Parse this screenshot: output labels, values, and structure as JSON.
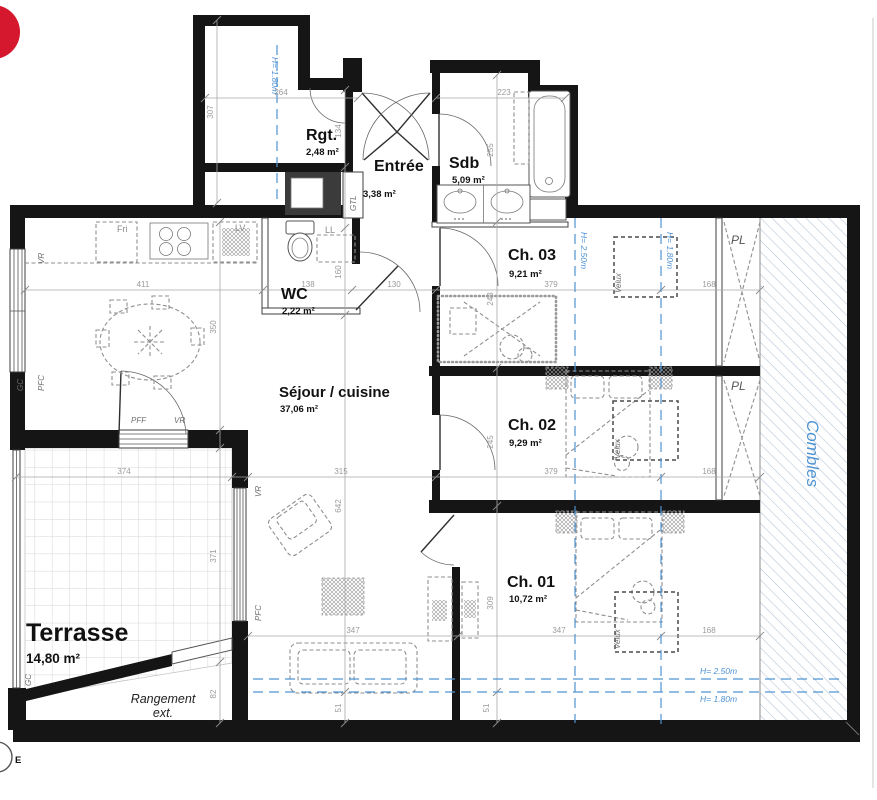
{
  "rooms": {
    "rgt": {
      "name": "Rgt.",
      "area": "2,48 m²"
    },
    "entree": {
      "name": "Entrée",
      "area": "3,38 m²"
    },
    "sdb": {
      "name": "Sdb",
      "area": "5,09 m²"
    },
    "wc": {
      "name": "WC",
      "area": "2,22 m²"
    },
    "ch03": {
      "name": "Ch. 03",
      "area": "9,21 m²"
    },
    "ch02": {
      "name": "Ch. 02",
      "area": "9,29 m²"
    },
    "ch01": {
      "name": "Ch. 01",
      "area": "10,72 m²"
    },
    "sejour": {
      "name": "Séjour / cuisine",
      "area": "37,06 m²"
    },
    "terrasse": {
      "name": "Terrasse",
      "area": "14,80 m²"
    }
  },
  "annotations": {
    "pl": "PL",
    "velux": "Velux",
    "combles": "Combles",
    "gtl": "GTL",
    "ll": "LL",
    "lv": "LV",
    "fri": "Fri",
    "vr": "VR",
    "pfc": "PFC",
    "pff": "PFF",
    "gc": "GC",
    "rangement_1": "Rangement",
    "rangement_2": "ext.",
    "compass_e": "E"
  },
  "height_markers": {
    "h250": "H= 2.50m",
    "h180": "H= 1.80m"
  },
  "dimensions": {
    "v307": "307",
    "h264": "264",
    "v134": "134",
    "h223": "223",
    "v255": "255",
    "h411": "411",
    "h138": "138",
    "h130": "130",
    "v160": "160",
    "v350": "350",
    "v243": "243",
    "h379_ch03": "379",
    "h168_ch03": "168",
    "v245": "245",
    "h379_ch02": "379",
    "h168_ch02": "168",
    "v309": "309",
    "h347_sejour": "347",
    "h347_ch01": "347",
    "h168_ch01": "168",
    "h374": "374",
    "h315": "315",
    "v371": "371",
    "v82": "82",
    "v642": "642",
    "v51_sejour": "51",
    "v51_ch01": "51"
  },
  "colors": {
    "wall": "#151515",
    "dim_line": "#a8a8a8",
    "dim_text": "#9b9b9b",
    "blue": "#4f93d2",
    "hatch": "#b7c6d8",
    "red": "#d5182d",
    "furniture": "#8f8f8f",
    "tile_line": "#d6d6d6",
    "annot": "#6e6e6e"
  }
}
